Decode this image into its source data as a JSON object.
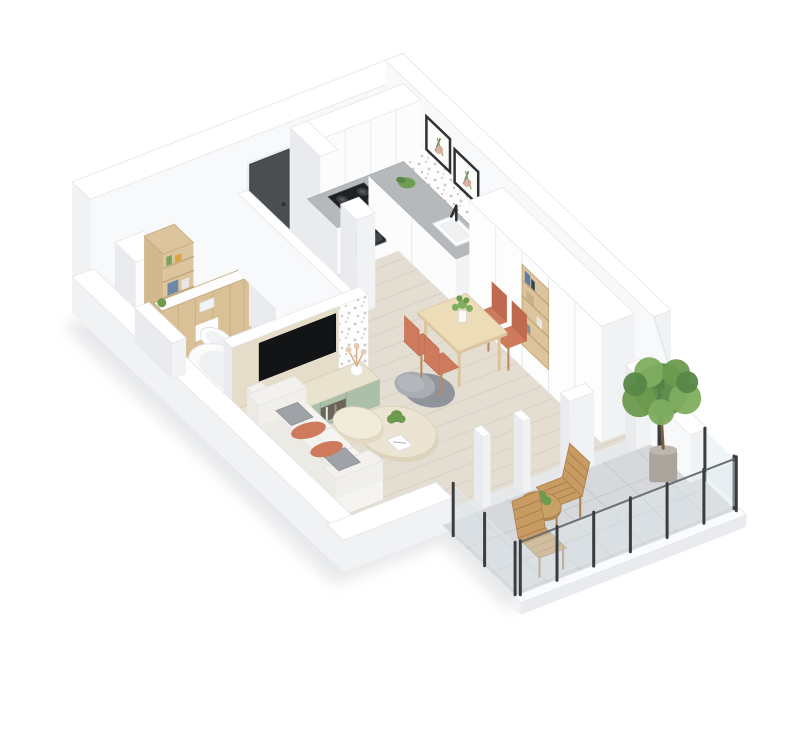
{
  "scene": {
    "title": "Isometric 3D cutaway floor plan of a one-bedroom apartment with balcony",
    "view": "isometric-cutaway-render",
    "background": "#ffffff"
  },
  "rooms": [
    {
      "name": "bathroom",
      "label": "Bathroom",
      "floor": "white-tile",
      "objects": [
        {
          "name": "storage-cabinet",
          "label": "White storage cabinet",
          "color": "#fcfcfd"
        },
        {
          "name": "wood-shelf-unit",
          "label": "Wooden open shelf with bottles and books",
          "color": "#dcc49c"
        },
        {
          "name": "wood-accent-wall",
          "label": "Wooden half wall behind toilet",
          "color": "#d9c096"
        },
        {
          "name": "toilet",
          "label": "Wall-hung toilet",
          "color": "#ffffff"
        },
        {
          "name": "washing-machine",
          "label": "Washing machine with round door",
          "color": "#fcfcfd"
        },
        {
          "name": "bathtub",
          "label": "White bathtub",
          "color": "#fbfbfc"
        },
        {
          "name": "small-plant",
          "label": "Small green plant",
          "color": "#6c9a4e"
        }
      ]
    },
    {
      "name": "entry-hall",
      "label": "Entry hall",
      "floor": "light-wood",
      "objects": [
        {
          "name": "entry-door",
          "label": "Dark gray entry door",
          "color": "#4b4e51"
        },
        {
          "name": "doormat",
          "label": "Beige doormat",
          "color": "#eae1d1"
        }
      ]
    },
    {
      "name": "kitchen",
      "label": "Kitchen",
      "floor": "light-wood",
      "objects": [
        {
          "name": "upper-cabinets",
          "label": "White upper cabinets",
          "color": "#fcfcfd"
        },
        {
          "name": "tall-cabinet",
          "label": "Tall white cabinet column",
          "color": "#fcfcfd"
        },
        {
          "name": "counter",
          "label": "L-shaped counter with gray worktop",
          "color": "#b6b9bb"
        },
        {
          "name": "cooktop",
          "label": "Black 4-burner cooktop",
          "color": "#1e2022"
        },
        {
          "name": "oven",
          "label": "Built-in oven",
          "color": "#2b2e30"
        },
        {
          "name": "sink",
          "label": "Kitchen sink with black faucet",
          "color": "#fdfdfd"
        },
        {
          "name": "backsplash",
          "label": "White terrazzo tile backsplash",
          "color": "#fdfdfd"
        },
        {
          "name": "wall-art",
          "label": "Two framed botanical prints",
          "count": 2,
          "color": "#2f3133"
        },
        {
          "name": "counter-plant",
          "label": "Small plant on counter",
          "color": "#6f9e52"
        },
        {
          "name": "divider-pillar",
          "label": "Free-standing white pillar",
          "color": "#fcfcfd"
        }
      ]
    },
    {
      "name": "living-dining",
      "label": "Living and dining room",
      "floor": "light-wood",
      "objects": [
        {
          "name": "wardrobe",
          "label": "Full-height white wardrobe with open wooden shelf niche",
          "color": "#fdfdfe"
        },
        {
          "name": "dining-table",
          "label": "Light wood dining table",
          "color": "#ecdcb8"
        },
        {
          "name": "dining-chair",
          "label": "Terracotta dining chair",
          "count": 4,
          "color": "#cd7a5d"
        },
        {
          "name": "table-plant",
          "label": "Green plant centerpiece in vase",
          "color": "#6c9a4e"
        },
        {
          "name": "tv",
          "label": "Wall-mounted TV",
          "color": "#121416"
        },
        {
          "name": "tv-wall-panel",
          "label": "Cream TV wall panel with terrazzo section",
          "color": "#e5ddc9"
        },
        {
          "name": "media-console",
          "label": "Media console with sage green fronts",
          "color": "#abbfa9"
        },
        {
          "name": "pampas-vase",
          "label": "White vase with dried pampas",
          "color": "#e7cdb0"
        },
        {
          "name": "sofa",
          "label": "White sofa with gray and terracotta cushions",
          "color": "#f5f4f1"
        },
        {
          "name": "coffee-table",
          "label": "Cream organic coffee table",
          "count": 2,
          "color": "#ece4d2"
        },
        {
          "name": "armchair",
          "label": "Gray armchair",
          "color": "#8f939a"
        },
        {
          "name": "magazine",
          "label": "Magazine on coffee table",
          "color": "#ffffff"
        }
      ]
    },
    {
      "name": "balcony",
      "label": "Balcony",
      "floor": "gray-stone-tile",
      "objects": [
        {
          "name": "glass-railing",
          "label": "Glass railing with dark posts",
          "color": "#dde8ec"
        },
        {
          "name": "outdoor-chair",
          "label": "Wooden slatted outdoor chair",
          "count": 2,
          "color": "#c89b62"
        },
        {
          "name": "outdoor-table",
          "label": "Round wooden outdoor table with plant",
          "color": "#c9a066"
        },
        {
          "name": "potted-tree",
          "label": "Potted green tree",
          "color": "#5f8f4a"
        },
        {
          "name": "wall-lamp",
          "label": "Dark wall fixture",
          "color": "#3a3d40"
        }
      ]
    }
  ],
  "palette": {
    "bg": "#ffffff",
    "wallTop": "#ffffff",
    "wallEdge": "#e4e6e9",
    "wallInner": "#f8f9fa",
    "wallShade": "#e9ebee",
    "wallMid": "#f1f2f4",
    "woodFloor": "#e3ddd2",
    "plankLine": "#d6cfc3",
    "tile": "#f4f5f6",
    "tileLine": "#e7e9eb",
    "balconyTile": "#d6d8db",
    "balconyLine": "#c7c9cc",
    "counter": "#b6b9bb",
    "cabinet": "#fcfcfd",
    "cabinetSeam": "#e8eaed",
    "dark": "#1e2022",
    "steel": "#9aa0a4",
    "ovenDark": "#2b2e30",
    "door": "#4b4e51",
    "woodLight": "#dcc49c",
    "woodMid": "#d2b88c",
    "woodDark": "#c5a87e",
    "woodWall": "#d9c096",
    "tableWood": "#ecdcb8",
    "tableEdge": "#dac5a0",
    "terracotta": "#cd7a5d",
    "terracottaDark": "#bf6a4f",
    "sage": "#abbfa9",
    "cream": "#e9e2cf",
    "creamDark": "#dcd2b8",
    "sofa": "#f5f4f1",
    "sofaShade": "#eceae5",
    "gray1": "#9fa3a8",
    "gray2": "#8f939a",
    "gray3": "#a9adb2",
    "green1": "#6c9a4e",
    "green2": "#7fae60",
    "green3": "#578747",
    "outWood": "#c89b62",
    "outWoodDark": "#aa7f4e",
    "glass": "#dde8ec",
    "rail": "#3a3d40",
    "pot": "#aba49c",
    "trunk": "#7a5f43",
    "tv": "#121416",
    "artFrame": "#2f3133",
    "artPink": "#d8a49a",
    "shadow": "#d4d7da",
    "matBeige": "#eae1d1"
  }
}
